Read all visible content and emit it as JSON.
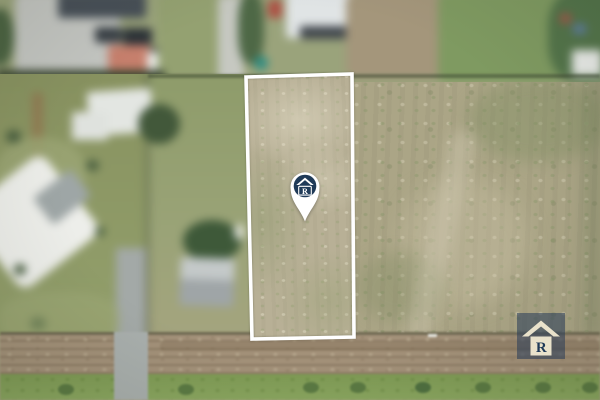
{
  "scene": {
    "type": "aerial-drone-photo",
    "subject": "vacant land parcel outlined in white with brand location pin, rural residential surroundings"
  },
  "marker": {
    "letter": "R"
  },
  "watermark": {
    "letter": "R"
  },
  "colors": {
    "navy": "#1f3a58",
    "cream": "#e9e2cb",
    "boundary_white": "#ffffff",
    "watermark_bg": "rgba(38,58,88,0.55)"
  }
}
